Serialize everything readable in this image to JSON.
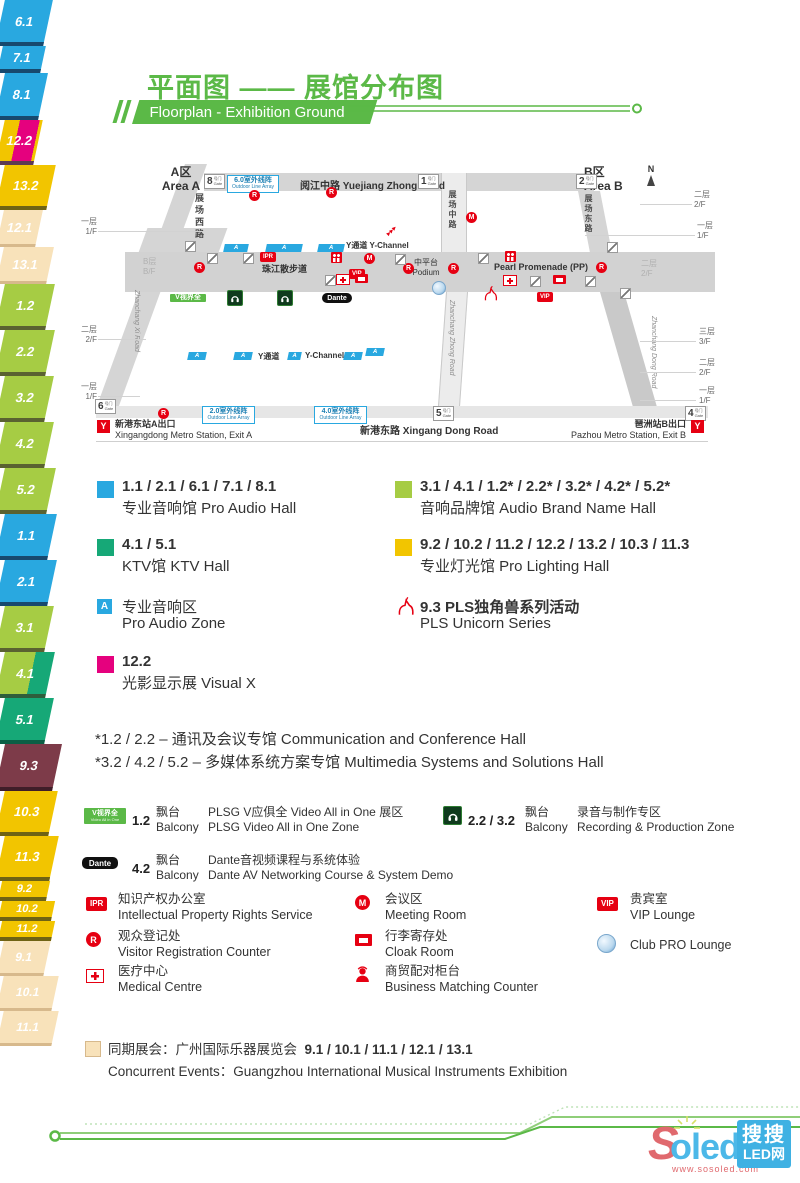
{
  "header": {
    "title": "平面图 —— 展馆分布图",
    "subtitle": "Floorplan - Exhibition Ground"
  },
  "colors": {
    "green": "#5bb947",
    "blue": "#29a8e0",
    "lightgreen": "#a6cc44",
    "teal": "#16a877",
    "yellow": "#f2c500",
    "magenta": "#e5017e",
    "maroon": "#7d3b49",
    "beige": "#f8e2ba",
    "red": "#e60012"
  },
  "map": {
    "area_a_zh": "A区",
    "area_a_en": "Area A",
    "area_b_zh": "B区",
    "area_b_en": "Area B",
    "north": "N",
    "a_label": "A",
    "gates": {
      "g8": "8",
      "g1": "1",
      "g2": "2",
      "g6": "6",
      "g5": "5",
      "g4": "4",
      "zh": "号门",
      "en": "Gate"
    },
    "roads": {
      "yuejiang": "阅江中路  Yuejiang Zhong Road",
      "xingang": "新港东路  Xingang Dong Road",
      "zhanchang_xi_zh": "展场西路",
      "zhanchang_xi_en": "Zhanchang Xi Road",
      "zhanchang_zhong_zh": "展场中路",
      "zhanchang_zhong_en": "Zhanchang Zhong Road",
      "zhanchang_dong_zh": "展场东路",
      "zhanchang_dong_en": "Zhanchang Dong Road",
      "promenade_zh": "珠江散步道",
      "promenade_en": "Pearl Promenade (PP)",
      "podium_zh": "中平台",
      "podium_en": "Podium",
      "ychannel": "Y通道  Y-Channel",
      "ychannel_zh": "Y通道",
      "ychannel_en": "Y-Channel"
    },
    "floors": {
      "f1_zh": "一层",
      "f1_en": "1/F",
      "f2_zh": "二层",
      "f2_en": "2/F",
      "f3_zh": "三层",
      "f3_en": "3/F",
      "bf_zh": "B层",
      "bf_en": "B/F"
    },
    "badges": {
      "ipr": "IPR",
      "vip": "VIP",
      "r": "R",
      "m": "M",
      "metro": "Y"
    },
    "outdoor": {
      "l6_zh": "6.0室外线阵",
      "l2_zh": "2.0室外线阵",
      "l4_zh": "4.0室外线阵",
      "en": "Outdoor Line Array"
    },
    "vlabel_line1": "V视界全",
    "vlabel_line2": "Video All in One",
    "dante": "Dante",
    "arrows": "▶▶▶",
    "metro_a_zh": "新港东站A出口",
    "metro_a_en": "Xingangdong Metro Station, Exit A",
    "metro_b_zh": "琶洲站B出口",
    "metro_b_en": "Pazhou Metro Station, Exit B",
    "halls": [
      {
        "id": "6.1"
      },
      {
        "id": "7.1"
      },
      {
        "id": "8.1"
      },
      {
        "id": "12.2"
      },
      {
        "id": "13.2"
      },
      {
        "id": "12.1"
      },
      {
        "id": "13.1"
      },
      {
        "id": "1.2"
      },
      {
        "id": "2.2"
      },
      {
        "id": "3.2"
      },
      {
        "id": "4.2"
      },
      {
        "id": "5.2"
      },
      {
        "id": "1.1"
      },
      {
        "id": "2.1"
      },
      {
        "id": "3.1"
      },
      {
        "id": "4.1"
      },
      {
        "id": "5.1"
      },
      {
        "id": "9.3"
      },
      {
        "id": "10.3"
      },
      {
        "id": "11.3"
      },
      {
        "id": "9.2"
      },
      {
        "id": "10.2"
      },
      {
        "id": "11.2"
      },
      {
        "id": "9.1"
      },
      {
        "id": "10.1"
      },
      {
        "id": "11.1"
      }
    ]
  },
  "legend": {
    "items": [
      {
        "title": "1.1 / 2.1 / 6.1 / 7.1 / 8.1",
        "name": "专业音响馆 Pro Audio Hall"
      },
      {
        "title": "3.1 / 4.1 / 1.2* / 2.2* / 3.2* / 4.2* / 5.2*",
        "name": "音响品牌馆 Audio Brand Name Hall"
      },
      {
        "title": "4.1 / 5.1",
        "name": "KTV馆 KTV Hall"
      },
      {
        "title": "9.2 / 10.2 / 11.2 / 12.2 / 13.2 / 10.3 / 11.3",
        "name": "专业灯光馆 Pro Lighting Hall"
      },
      {
        "title": "专业音响区",
        "name": "Pro Audio Zone"
      },
      {
        "title": "9.3 PLS独角兽系列活动",
        "name": "PLS Unicorn Series"
      },
      {
        "title": "12.2",
        "name": "光影显示展 Visual X"
      }
    ]
  },
  "footnotes": [
    "*1.2 / 2.2 – 通讯及会议专馆 Communication and Conference Hall",
    "*3.2 / 4.2 / 5.2 – 多媒体系统方案专馆 Multimedia Systems and Solutions Hall"
  ],
  "balcony": [
    {
      "halls": "1.2",
      "loc_zh": "飘台",
      "loc_en": "Balcony",
      "zh": "PLSG V应俱全 Video All in One 展区",
      "en": "PLSG Video All in One Zone"
    },
    {
      "halls": "2.2 / 3.2",
      "loc_zh": "飘台",
      "loc_en": "Balcony",
      "zh": "录音与制作专区",
      "en": "Recording & Production Zone"
    },
    {
      "halls": "4.2",
      "loc_zh": "飘台",
      "loc_en": "Balcony",
      "zh": "Dante音视频课程与系统体验",
      "en": "Dante AV Networking Course & System Demo"
    }
  ],
  "facilities": [
    {
      "zh": "知识产权办公室",
      "en": "Intellectual Property Rights Service"
    },
    {
      "zh": "观众登记处",
      "en": "Visitor Registration Counter"
    },
    {
      "zh": "医疗中心",
      "en": "Medical Centre"
    },
    {
      "zh": "会议区",
      "en": "Meeting Room"
    },
    {
      "zh": "行李寄存处",
      "en": "Cloak Room"
    },
    {
      "zh": "商贸配对柜台",
      "en": "Business Matching Counter"
    },
    {
      "zh": "贵宾室",
      "en": "VIP Lounge"
    },
    {
      "zh": "",
      "en": "Club PRO Lounge"
    }
  ],
  "concurrent": {
    "zh": "同期展会：广州国际乐器展览会",
    "halls": "9.1 / 10.1 / 11.1 / 12.1 / 13.1",
    "en": "Concurrent Events：Guangzhou International Musical Instruments Exhibition"
  },
  "watermark": {
    "s": "S",
    "oled": "oled",
    "url": "www.sosoled.com",
    "box1": "搜搜",
    "box2": "LED网"
  }
}
